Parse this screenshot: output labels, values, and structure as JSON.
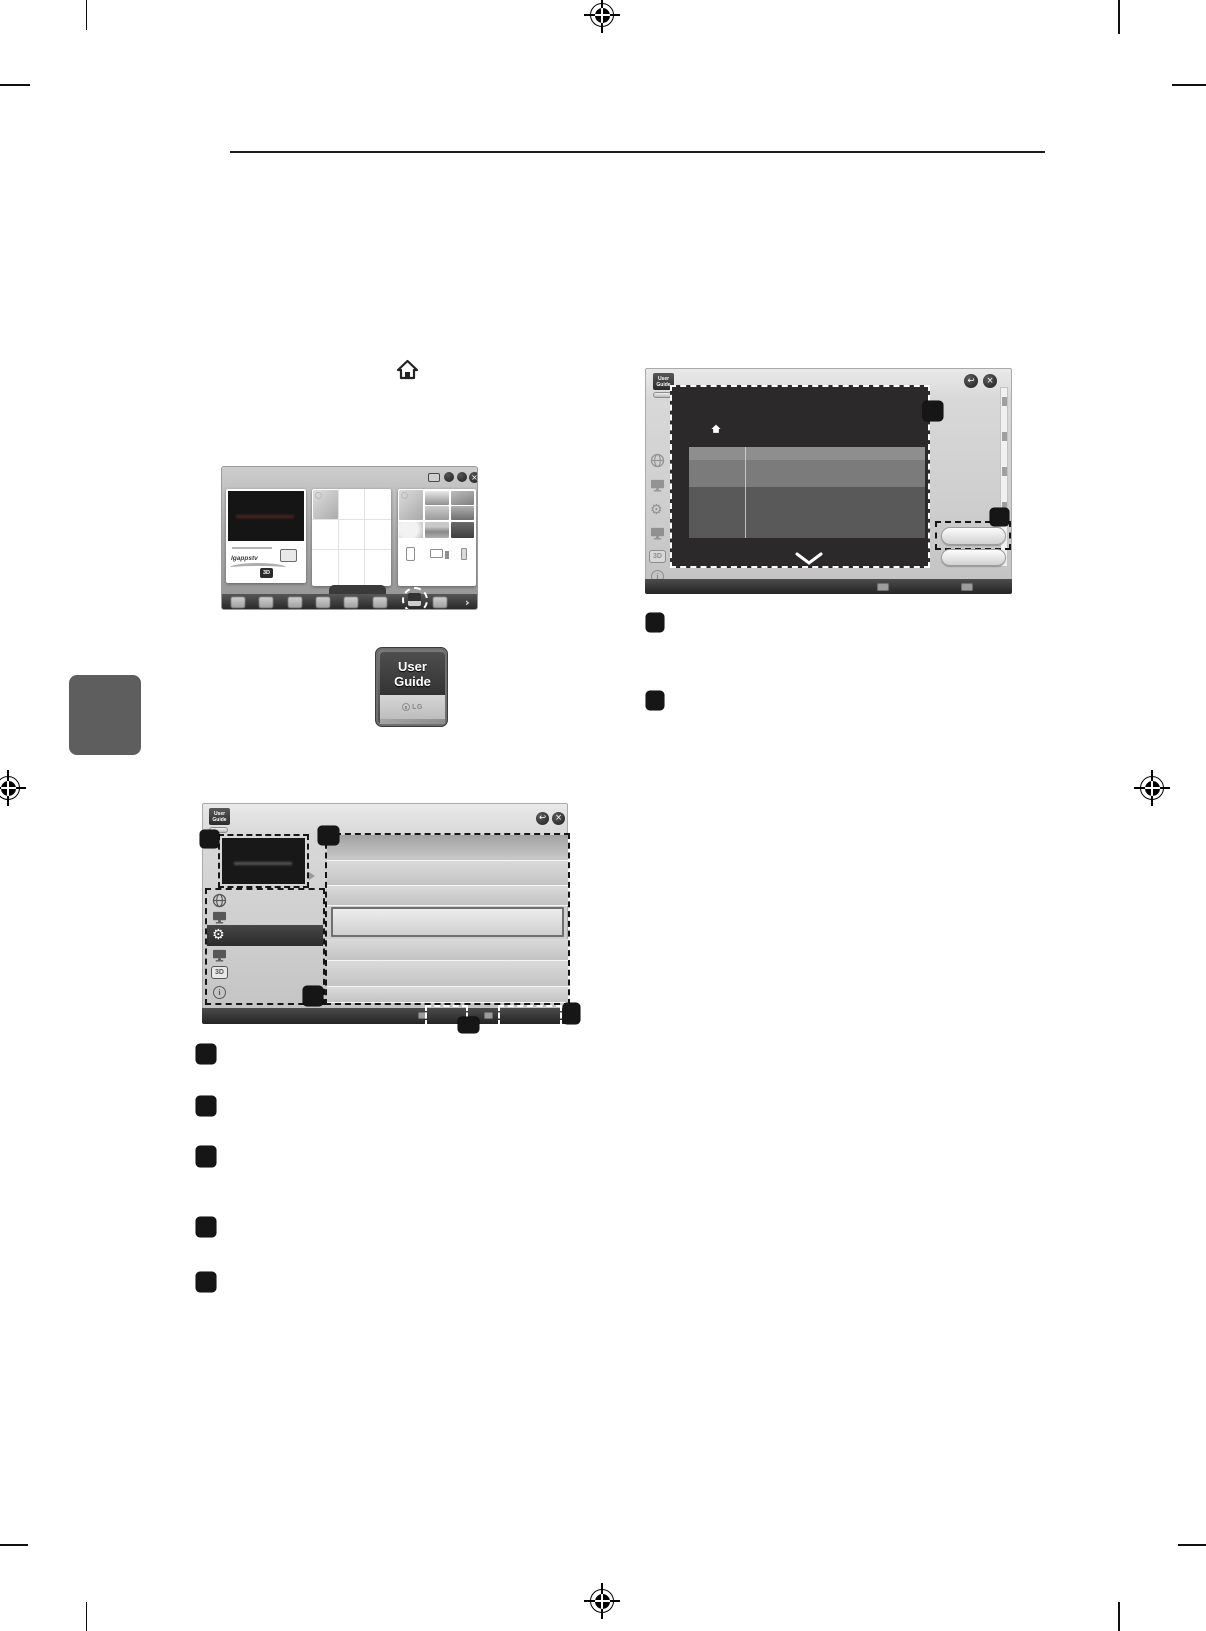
{
  "page": {
    "background": "#ffffff",
    "callout_color": "#161616",
    "chapter_tab_color": "#5e5e5e"
  },
  "icons": {
    "back_glyph": "↩",
    "close_glyph": "×",
    "more_arrow_glyph": "›",
    "info_glyph": "i",
    "gear_glyph": "⚙"
  },
  "user_guide_badge": {
    "line1": "User",
    "line2": "Guide"
  },
  "user_guide_app_icon": {
    "line1": "User",
    "line2": "Guide",
    "logo": "LG"
  },
  "tv_home": {
    "banner_text": "lgappstv",
    "badge_3d": "3D"
  },
  "sidebar": {
    "label_3d": "3D"
  }
}
